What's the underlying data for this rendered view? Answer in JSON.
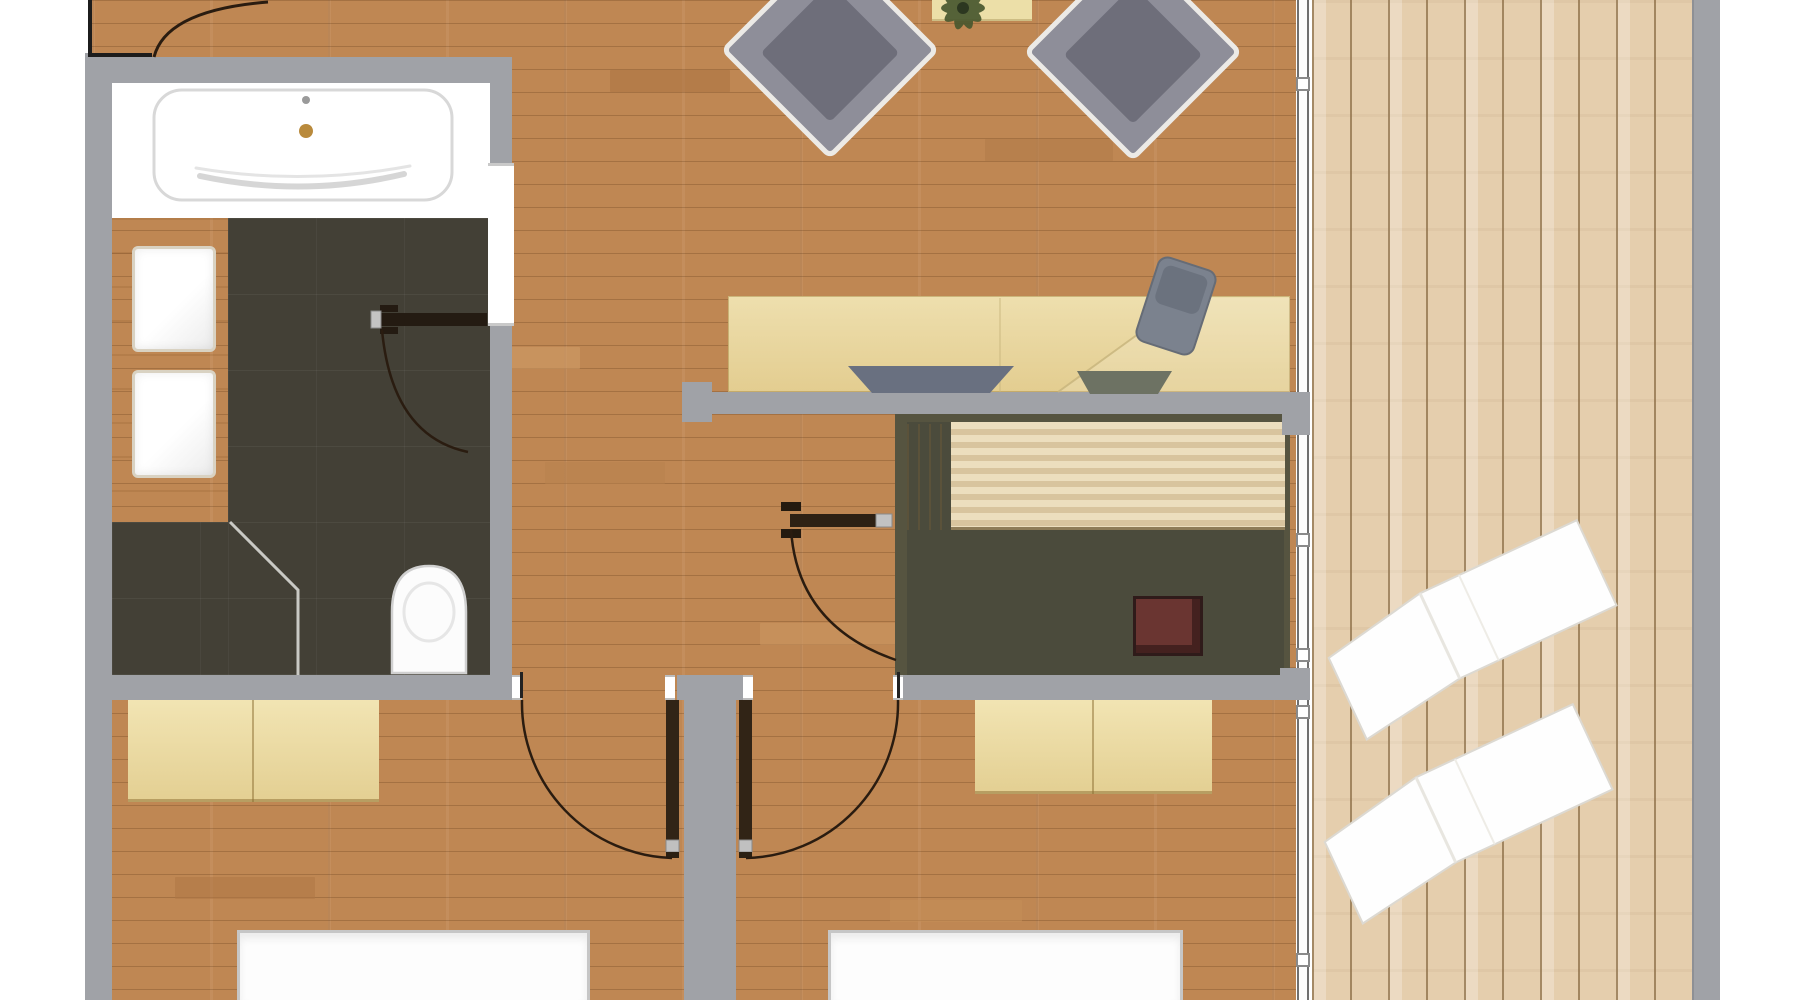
{
  "title": "apartment-floor-plan-top-view",
  "palette": {
    "bg": "#ffffff",
    "wall_gray": "#a0a2a7",
    "black_wall": "#1c1c1c",
    "parquet_base": "#bf8753",
    "deck_base": "#e5cead",
    "tile_dark": "#434036",
    "sauna_frame": "#565440",
    "sauna_floor": "#4b4b3c",
    "pale_wood": "#e8d8a2",
    "fixture_white": "#fdfdfd",
    "fixture_stroke": "#d0d0d0",
    "chair_body": "#8e8e99",
    "chair_cushion": "#6e6e7a",
    "door_leaf": "#2e2114",
    "door_metal": "#c2c2c2",
    "swing_arc": "#2a1c10",
    "glass_line": "#707070"
  },
  "rooms": [
    {
      "id": "entry",
      "floor": "parquet"
    },
    {
      "id": "living-area",
      "floor": "parquet"
    },
    {
      "id": "bathroom",
      "floor": "dark-tile"
    },
    {
      "id": "sauna",
      "floor": "dark-olive"
    },
    {
      "id": "hallway",
      "floor": "parquet"
    },
    {
      "id": "bedroom-left",
      "floor": "parquet"
    },
    {
      "id": "bedroom-right",
      "floor": "parquet"
    },
    {
      "id": "deck-terrace",
      "floor": "vertical-planks"
    }
  ],
  "fixtures": {
    "bathtub": 1,
    "washbasins": 2,
    "toilet": 1,
    "shower_screen": 1,
    "vanity_counter": 1,
    "armchairs": 2,
    "side_table_with_plant": 1,
    "desk": 1,
    "tucked_desk_chairs": 2,
    "office_chair": 1,
    "sauna_benches": 1,
    "sauna_heater": 1,
    "wardrobes": 2,
    "beds": 2,
    "sun_loungers": 2
  },
  "doors": {
    "entry_door": 1,
    "bathroom_door": 1,
    "sauna_door": 1,
    "bedroom_doors": 2,
    "swing_arcs_visible": 5
  },
  "glazing": {
    "glass_wall_connectors": 6
  }
}
